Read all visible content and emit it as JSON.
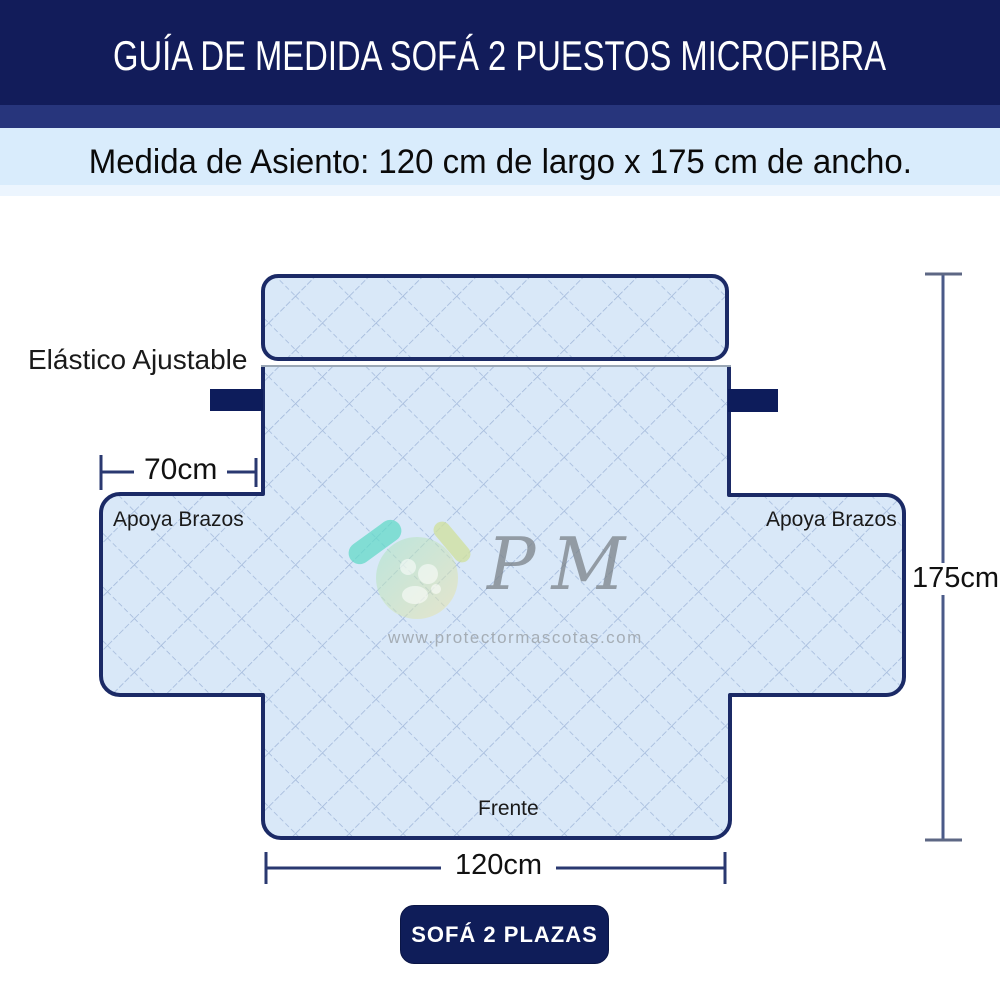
{
  "header": {
    "title": "GUÍA DE MEDIDA SOFÁ 2 PUESTOS MICROFIBRA",
    "subtitle": "Medida de Asiento: 120 cm de largo x 175 cm de ancho."
  },
  "diagram": {
    "labels": {
      "elastic_strap": "Elástico Ajustable",
      "armrest_left": "Apoya Brazos",
      "armrest_right": "Apoya Brazos",
      "front": "Frente"
    },
    "dimensions": {
      "armrest_depth": "70cm",
      "seat_length": "120cm",
      "total_width": "175cm"
    },
    "watermark": {
      "monogram": "PM",
      "website": "www.protectormascotas.com"
    }
  },
  "footer": {
    "badge_label": "SOFÁ 2 PLAZAS"
  },
  "colors": {
    "banner_bg": "#121c5a",
    "banner_accent": "#27357c",
    "subheader_bg": "#d9ecfc",
    "cover_fill": "#d9e8f8",
    "quilt_line": "#a2b8da",
    "outline": "#1b2a66",
    "strap": "#0d1c5b",
    "dimension_line": "#2a3870",
    "height_line": "#4a5a88",
    "badge_bg": "#0f1d59",
    "badge_text": "#ffffff",
    "logo_teal": "#63d9c8",
    "logo_yellow": "#e8e4a6"
  }
}
